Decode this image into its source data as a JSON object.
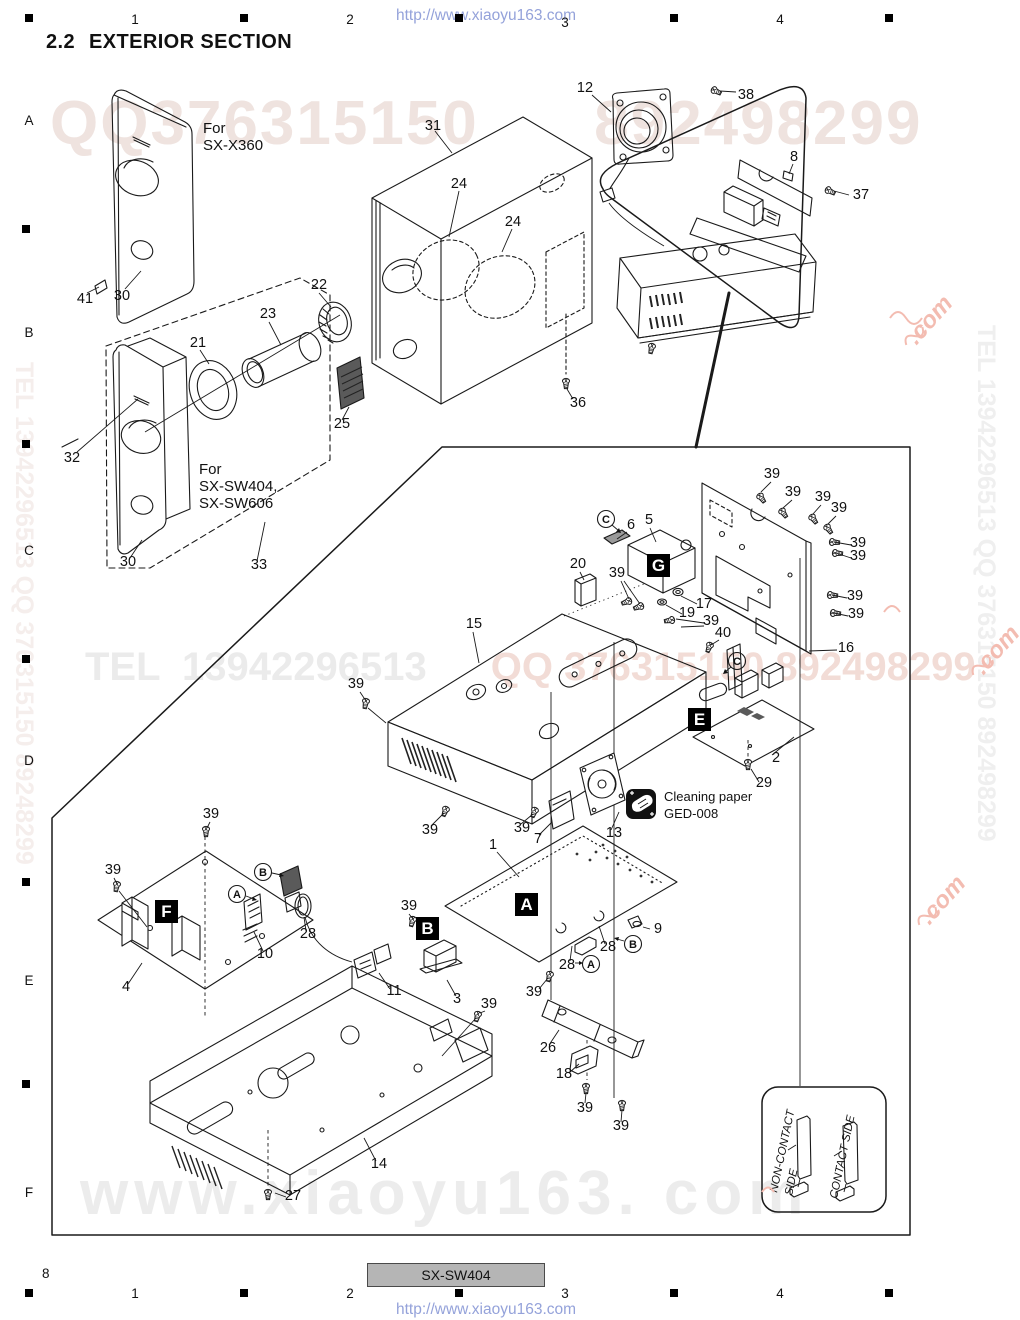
{
  "header": {
    "title_num": "2.2",
    "title_text": "EXTERIOR SECTION",
    "url": "http://www.xiaoyu163.com",
    "grid_cols": [
      "1",
      "2",
      "3",
      "4"
    ],
    "grid_rows": [
      "A",
      "B",
      "C",
      "D",
      "E",
      "F"
    ]
  },
  "footer": {
    "page_number": "8",
    "model": "SX-SW404",
    "url": "http://www.xiaoyu163.com"
  },
  "watermarks": {
    "top": "QQ376315150      892498299",
    "mid_left": "TEL  13942296513",
    "mid_right": "QQ 376315150 892498299",
    "bottom": "www.xiaoyu163. com",
    "left_vertical": "TEL 13942296513 QQ 376315150 89248299",
    "right_vertical": "TEL 13942296513 QQ 376315150 892498299",
    "pink": ".com"
  },
  "diagram": {
    "labels": {
      "n1": "1",
      "n2": "2",
      "n3": "3",
      "n4": "4",
      "n5": "5",
      "n6": "6",
      "n7": "7",
      "n8": "8",
      "n9": "9",
      "n10": "10",
      "n11": "11",
      "n12": "12",
      "n13": "13",
      "n14": "14",
      "n15": "15",
      "n16": "16",
      "n17": "17",
      "n18": "18",
      "n19": "19",
      "n20": "20",
      "n21": "21",
      "n22": "22",
      "n23": "23",
      "n24": "24",
      "n25": "25",
      "n26": "26",
      "n27": "27",
      "n28": "28",
      "n29": "29",
      "n30": "30",
      "n31": "31",
      "n32": "32",
      "n33": "33",
      "n36": "36",
      "n37": "37",
      "n38": "38",
      "n39": "39",
      "n40": "40",
      "n41": "41"
    },
    "boxes": {
      "A": "A",
      "B": "B",
      "E": "E",
      "F": "F",
      "G": "G"
    },
    "circles": {
      "A": "A",
      "B": "B",
      "C": "C"
    },
    "notes": {
      "x360_1": "For",
      "x360_2": "SX-X360",
      "sw_1": "For",
      "sw_2": "SX-SW404,",
      "sw_3": "SX-SW606",
      "clean_1": "Cleaning paper",
      "clean_2": "GED-008"
    },
    "inset": {
      "noncontact_1": "NON-CONTACT",
      "noncontact_2": "SIDE",
      "contact": "CONTACT SIDE"
    }
  }
}
